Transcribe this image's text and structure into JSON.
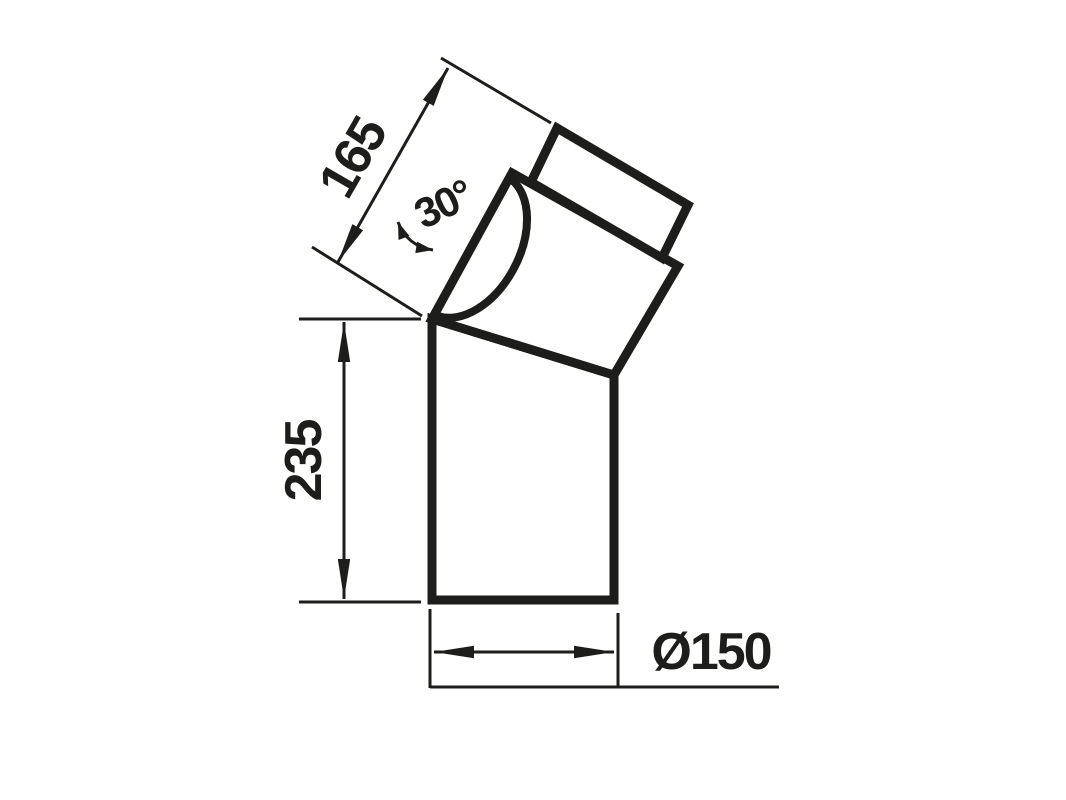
{
  "diagram": {
    "background": "#ffffff",
    "line_color": "#1d1d1b",
    "labels": {
      "upper_length": "165",
      "bend_angle": "30°",
      "lower_length": "235",
      "diameter": "Ø150"
    }
  }
}
